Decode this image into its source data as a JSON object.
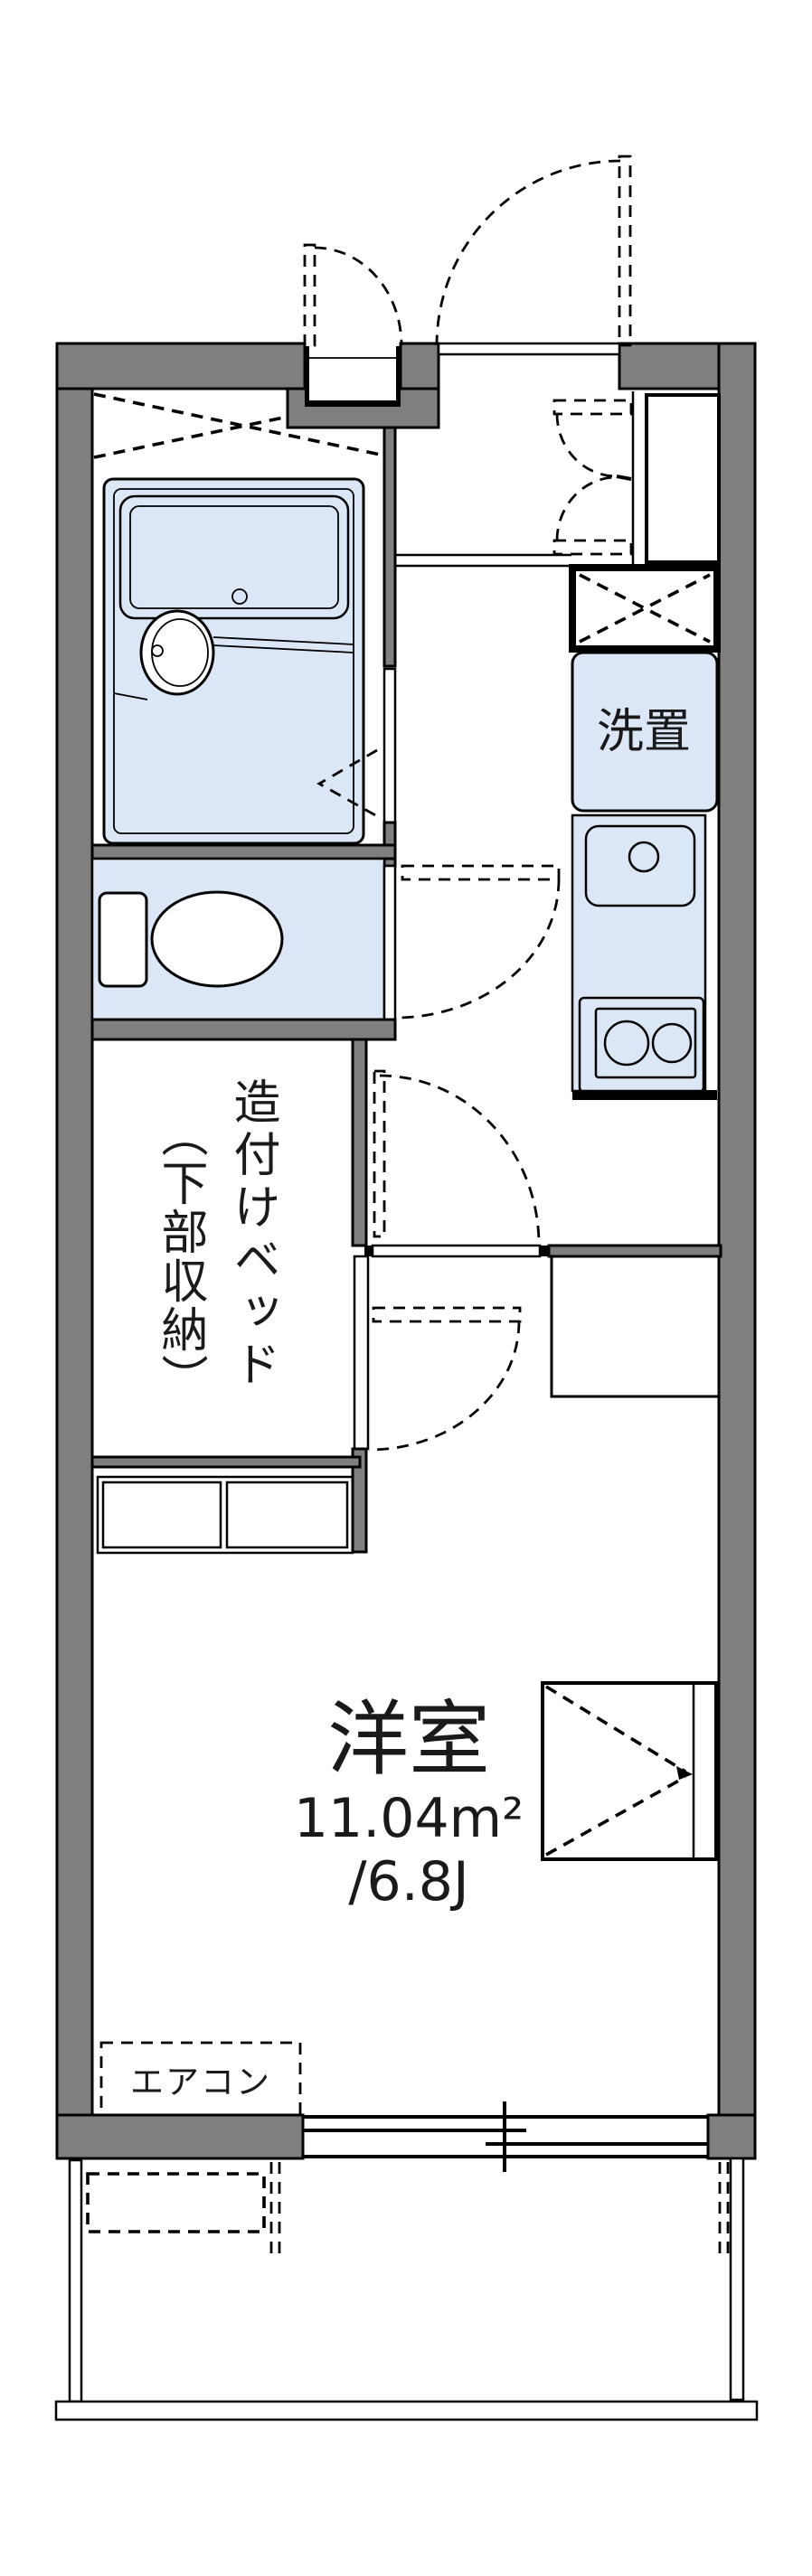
{
  "floorplan": {
    "labels": {
      "laundry_box": "洗置",
      "bed_line1": "造付けベッド",
      "bed_line2": "（下部収納）",
      "room_name": "洋室",
      "room_area_m2": "11.04m²",
      "room_area_jo": "/6.8J",
      "aircon": "エアコン"
    },
    "colors": {
      "wall_gray": "#7f7f7f",
      "fixture_blue": "#dbe7f6",
      "cabinet_cream": "#faf0db",
      "line_black": "#000000",
      "background": "#ffffff"
    }
  }
}
